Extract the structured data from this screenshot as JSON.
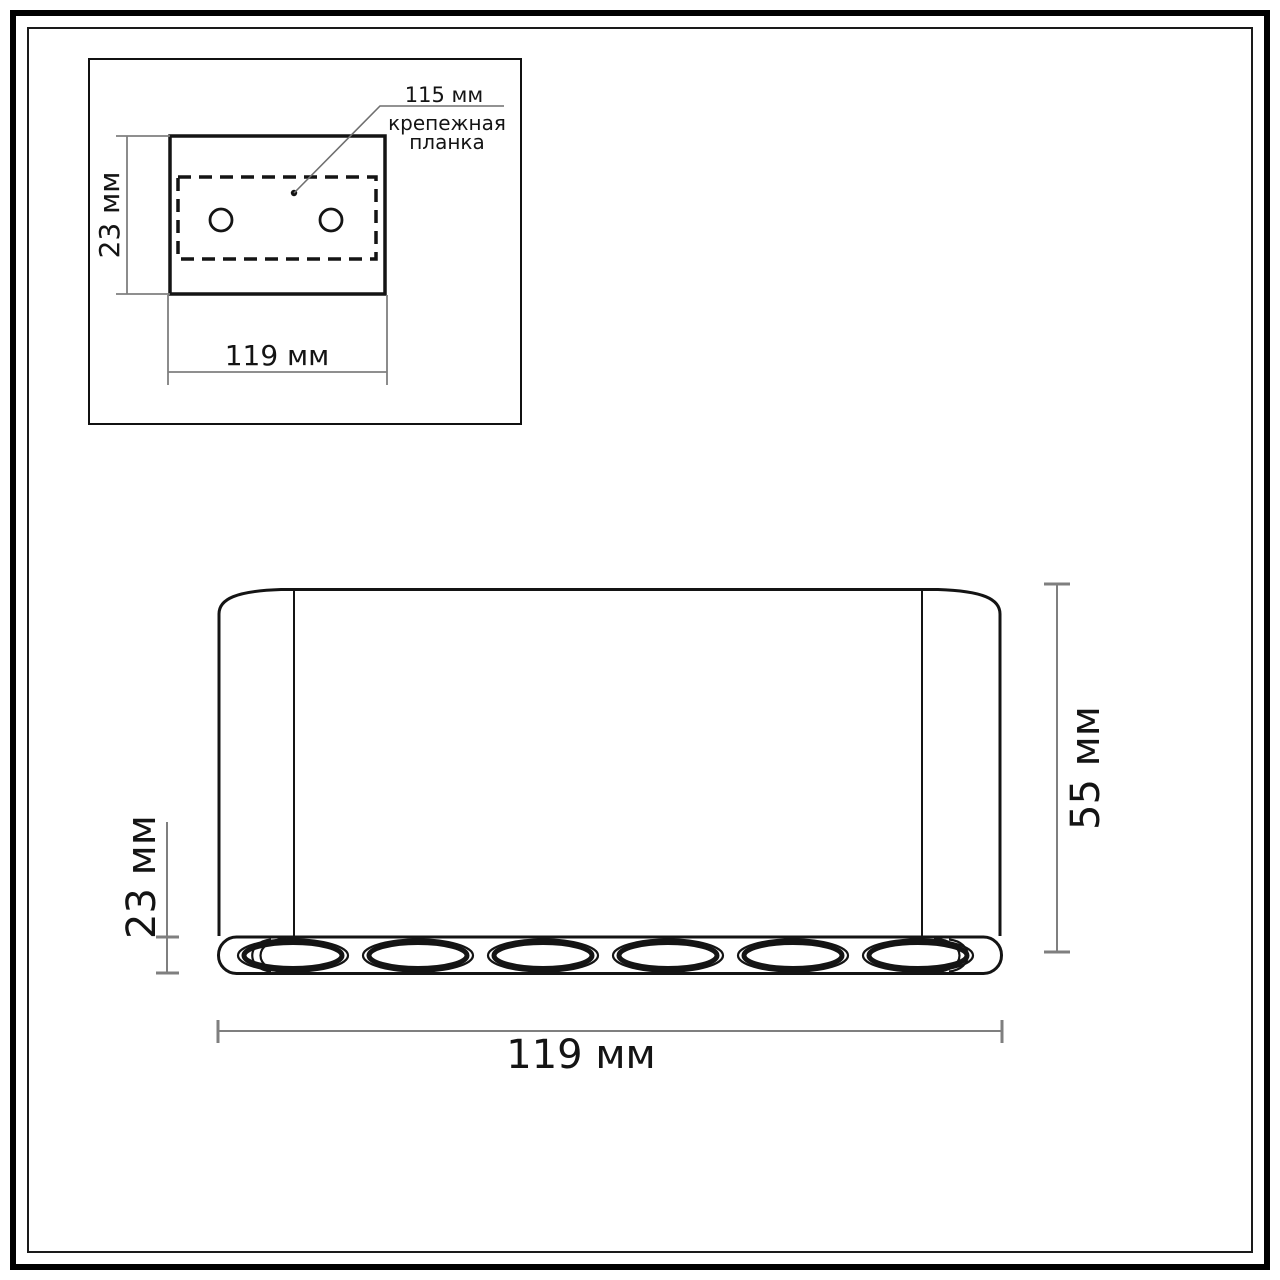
{
  "colors": {
    "ink": "#141414",
    "dim": "#7f7f7f",
    "bg": "#ffffff"
  },
  "mount_view": {
    "callout_value": "115 мм",
    "callout_label_line1": "крепежная",
    "callout_label_line2": "планка",
    "depth_label": "23 мм",
    "width_label": "119 мм",
    "hole_count": 2
  },
  "front_view": {
    "lip_label": "23 мм",
    "height_label": "55 мм",
    "width_label": "119 мм",
    "spot_count": 6
  }
}
